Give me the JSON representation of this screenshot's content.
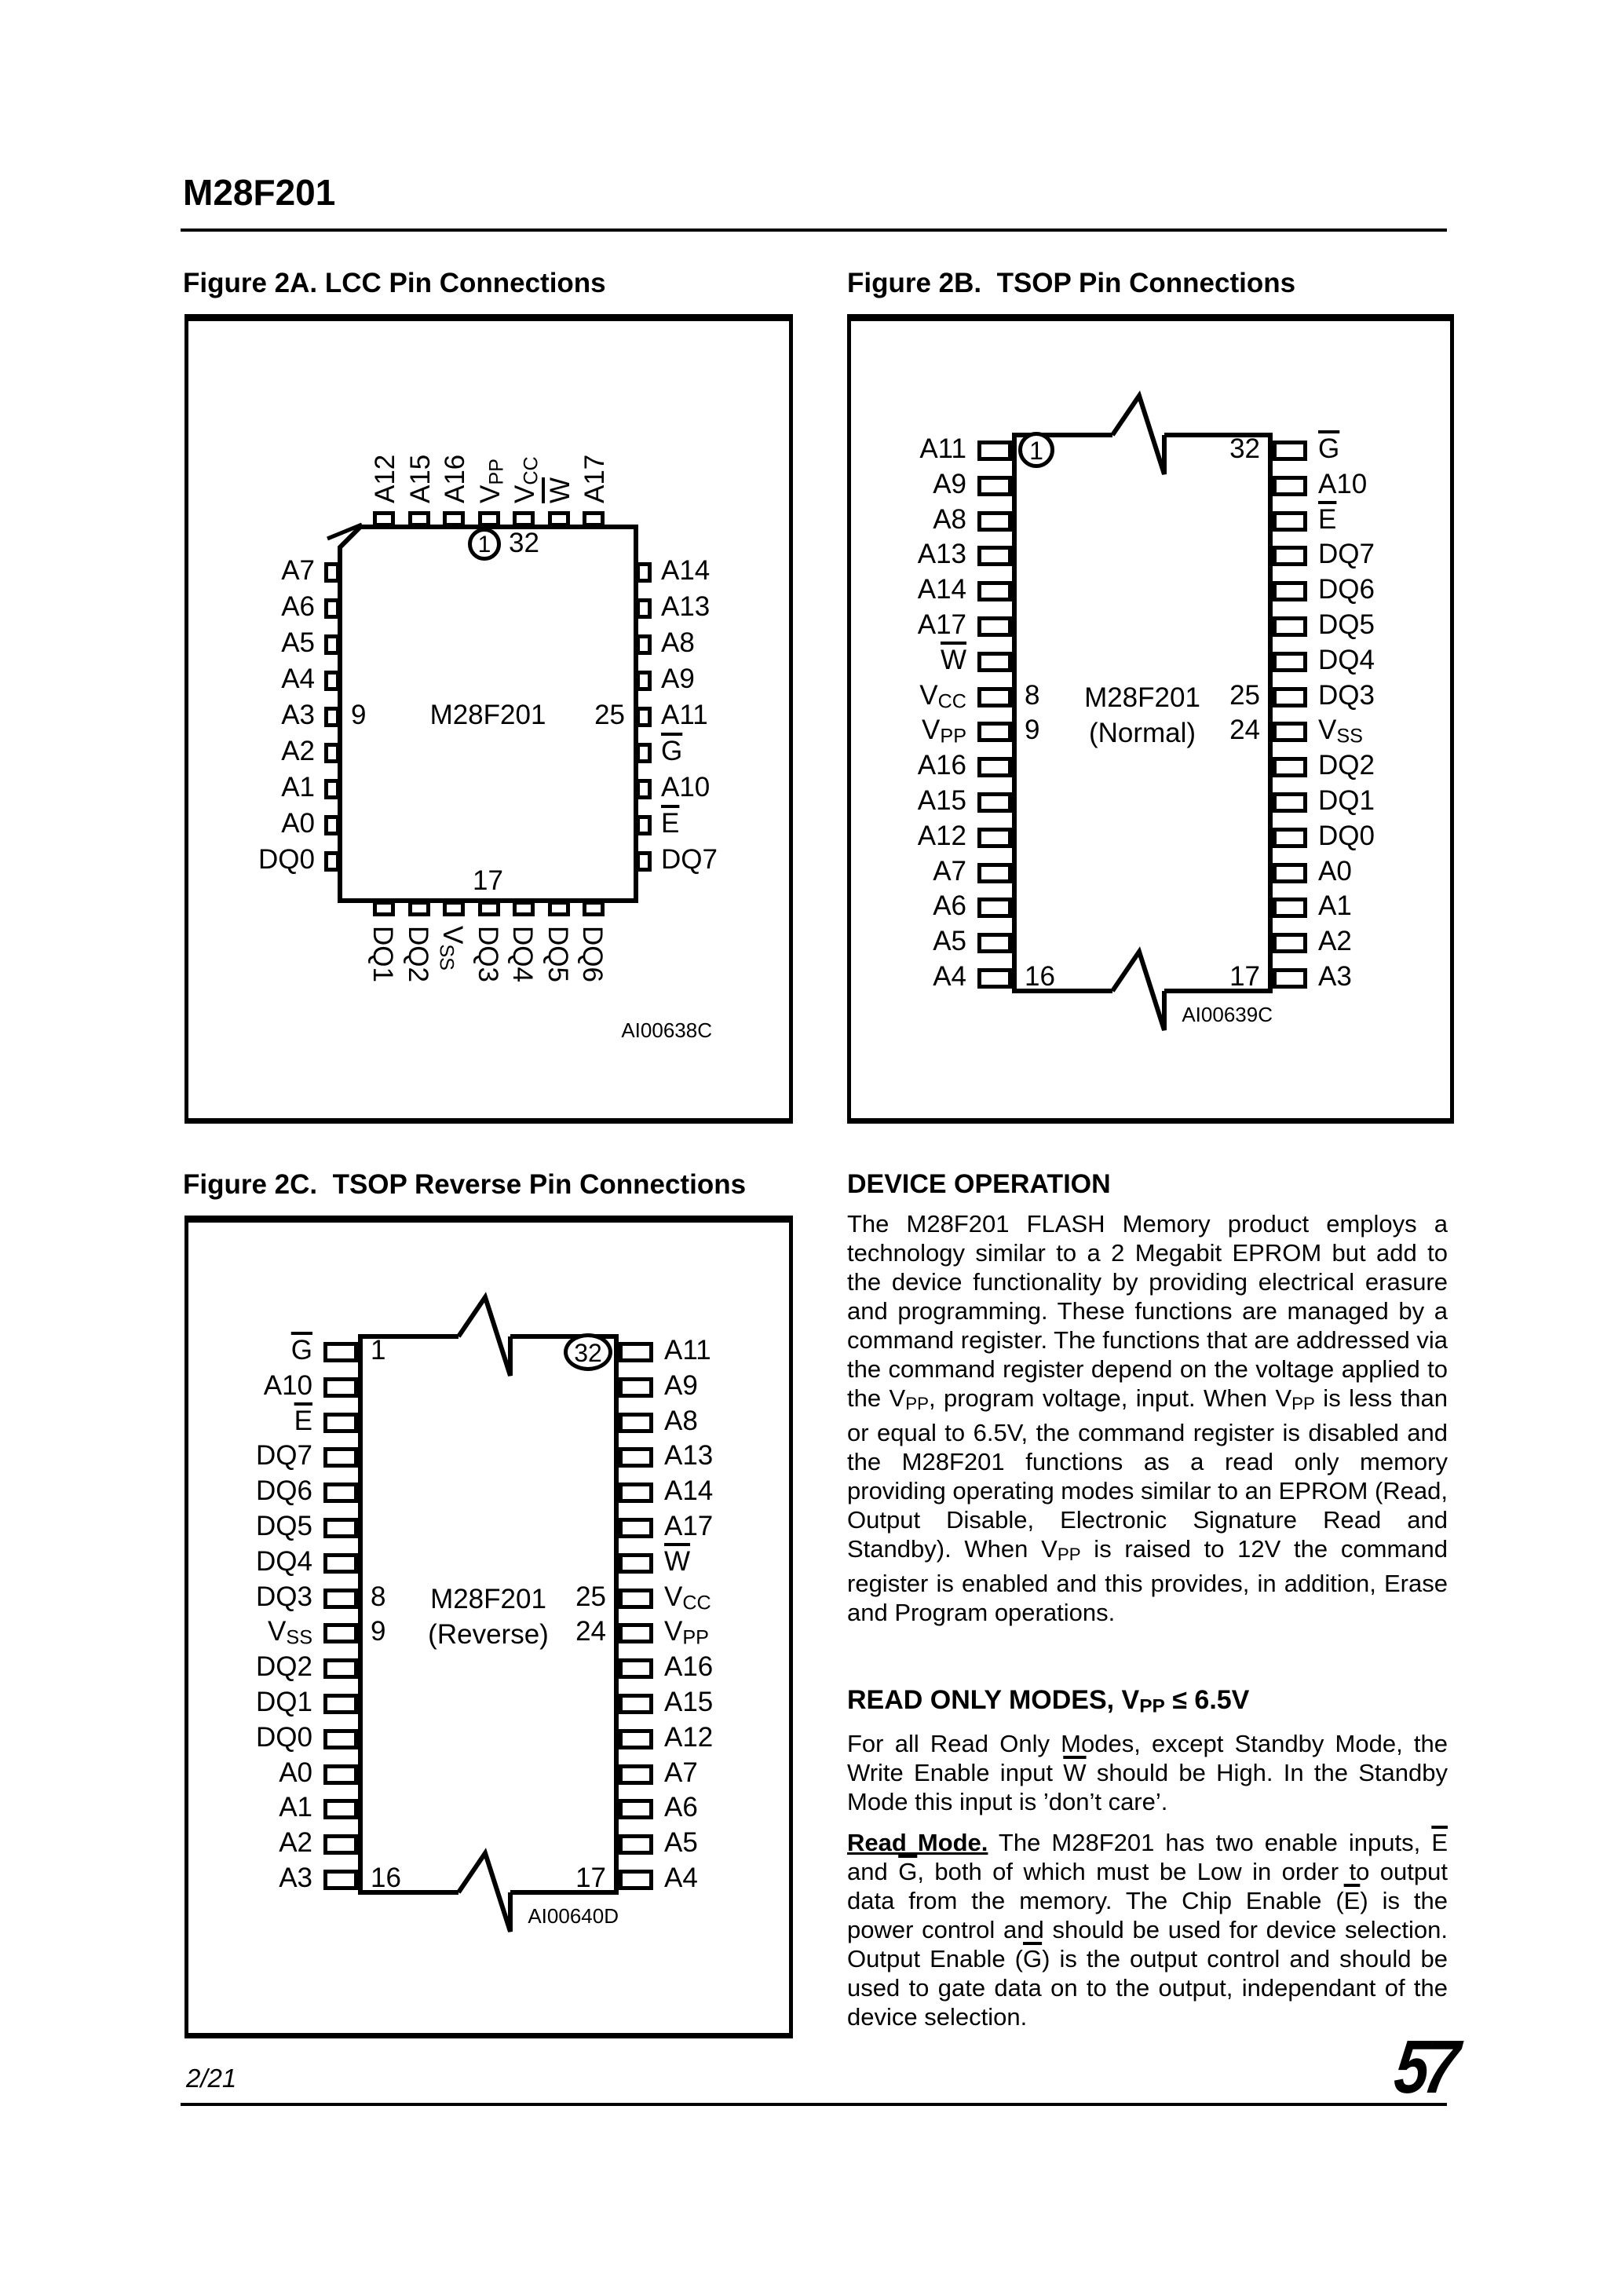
{
  "page": {
    "title": "M28F201"
  },
  "figures": {
    "fig2a": {
      "type": "lcc",
      "title": "Figure 2A. LCC Pin Connections",
      "chip_label": "M28F201",
      "code": "AI00638C",
      "top_pins": [
        "A12",
        "A15",
        "A16",
        {
          "t": "V",
          "sub": "PP"
        },
        {
          "t": "V",
          "sub": "CC"
        },
        {
          "t": "W",
          "over": true
        },
        "A17"
      ],
      "left_pins": [
        "A7",
        "A6",
        "A5",
        "A4",
        "A3",
        "A2",
        "A1",
        "A0",
        "DQ0"
      ],
      "right_pins": [
        "A14",
        "A13",
        "A8",
        "A9",
        "A11",
        {
          "t": "G",
          "over": true
        },
        "A10",
        {
          "t": "E",
          "over": true
        },
        "DQ7"
      ],
      "bottom_pins": [
        "DQ1",
        "DQ2",
        {
          "t": "V",
          "sub": "SS"
        },
        "DQ3",
        "DQ4",
        "DQ5",
        "DQ6"
      ],
      "numbers": {
        "first": "1",
        "top_right": "32",
        "left": "9",
        "right": "25",
        "bottom": "17"
      }
    },
    "fig2b": {
      "type": "tsop",
      "title": "Figure 2B.  TSOP Pin Connections",
      "chip_label": "M28F201",
      "chip_sublabel": "(Normal)",
      "code": "AI00639C",
      "left_pins": [
        "A11",
        "A9",
        "A8",
        "A13",
        "A14",
        "A17",
        {
          "t": "W",
          "over": true
        },
        {
          "t": "V",
          "sub": "CC"
        },
        {
          "t": "V",
          "sub": "PP"
        },
        "A16",
        "A15",
        "A12",
        "A7",
        "A6",
        "A5",
        "A4"
      ],
      "right_pins": [
        {
          "t": "G",
          "over": true
        },
        "A10",
        {
          "t": "E",
          "over": true
        },
        "DQ7",
        "DQ6",
        "DQ5",
        "DQ4",
        "DQ3",
        {
          "t": "V",
          "sub": "SS"
        },
        "DQ2",
        "DQ1",
        "DQ0",
        "A0",
        "A1",
        "A2",
        "A3"
      ],
      "numbers": {
        "left": [
          "1",
          "8",
          "9",
          "16"
        ],
        "right": [
          "32",
          "25",
          "24",
          "17"
        ],
        "circled_side": "left"
      }
    },
    "fig2c": {
      "type": "tsop",
      "title": "Figure 2C.  TSOP Reverse Pin Connections",
      "chip_label": "M28F201",
      "chip_sublabel": "(Reverse)",
      "code": "AI00640D",
      "left_pins": [
        {
          "t": "G",
          "over": true
        },
        "A10",
        {
          "t": "E",
          "over": true
        },
        "DQ7",
        "DQ6",
        "DQ5",
        "DQ4",
        "DQ3",
        {
          "t": "V",
          "sub": "SS"
        },
        "DQ2",
        "DQ1",
        "DQ0",
        "A0",
        "A1",
        "A2",
        "A3"
      ],
      "right_pins": [
        "A11",
        "A9",
        "A8",
        "A13",
        "A14",
        "A17",
        {
          "t": "W",
          "over": true
        },
        {
          "t": "V",
          "sub": "CC"
        },
        {
          "t": "V",
          "sub": "PP"
        },
        "A16",
        "A15",
        "A12",
        "A7",
        "A6",
        "A5",
        "A4"
      ],
      "numbers": {
        "left": [
          "1",
          "8",
          "9",
          "16"
        ],
        "right": [
          "32",
          "25",
          "24",
          "17"
        ],
        "circled_side": "right"
      }
    }
  },
  "sections": {
    "device_operation": {
      "heading": "DEVICE OPERATION",
      "body": [
        {
          "t": "The M28F201 FLASH Memory product employs a technology similar to a 2 Megabit EPROM but add to the device functionality by providing electrical erasure and programming. These functions are managed by a command register. The functions that are addressed via the command register depend on the voltage applied to the V"
        },
        {
          "t": "PP",
          "sub": true
        },
        {
          "t": ", program voltage, input. When V"
        },
        {
          "t": "PP",
          "sub": true
        },
        {
          "t": " is less than or equal to 6.5V, the command register is disabled and the M28F201 functions as a read only memory providing operating modes similar to an EPROM (Read, Output Disable, Electronic Signature Read and Standby). When V"
        },
        {
          "t": "PP",
          "sub": true
        },
        {
          "t": " is raised to 12V the command register is enabled and this provides, in addition, Erase and Program operations."
        }
      ]
    },
    "read_only": {
      "heading": [
        {
          "t": "READ ONLY MODES, V"
        },
        {
          "t": "PP",
          "sub": true
        },
        {
          "t": " ≤ 6.5V"
        }
      ],
      "para1": [
        {
          "t": "For all Read Only Modes, except Standby Mode, the Write Enable input "
        },
        {
          "t": "W",
          "over": true
        },
        {
          "t": " should be High. In the Standby Mode this input is ’don’t care’."
        }
      ],
      "para2": [
        {
          "t": "Read Mode.",
          "b": true,
          "u": true
        },
        {
          "t": " The M28F201 has two enable inputs, "
        },
        {
          "t": "E",
          "over": true
        },
        {
          "t": " and "
        },
        {
          "t": "G",
          "over": true
        },
        {
          "t": ", both of which must be Low in order to output data from the memory. The Chip Enable ("
        },
        {
          "t": "E",
          "over": true
        },
        {
          "t": ") is the power control and should be used for device selection. Output Enable ("
        },
        {
          "t": "G",
          "over": true
        },
        {
          "t": ") is the output control and should be used to gate data on to the output, independant of the device selection."
        }
      ]
    }
  },
  "footer": {
    "page_number": "2/21",
    "logo_glyph": "57"
  }
}
